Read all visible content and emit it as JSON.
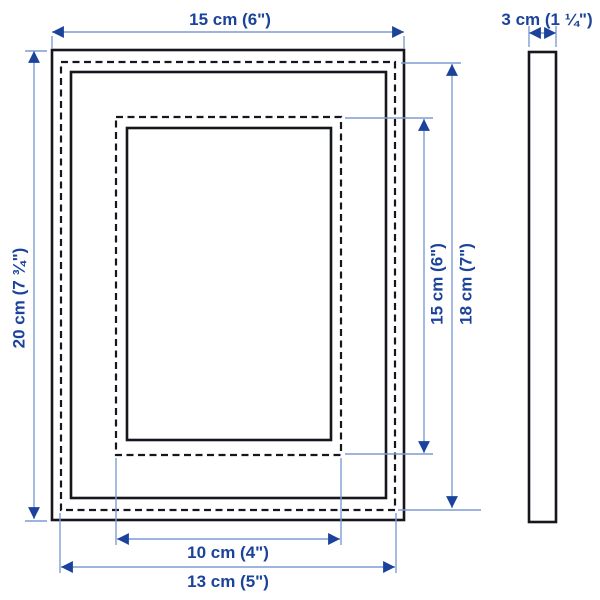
{
  "colors": {
    "background": "#ffffff",
    "frame_line": "#15171c",
    "dimension_line": "#7d9cd4",
    "dimension_accent": "#1c439b"
  },
  "front_view": {
    "outer_width_label": "15 cm (6\")",
    "outer_height_label": "20 cm (7 ¾\")",
    "glass_width_label": "13 cm (5\")",
    "glass_height_label": "18 cm (7\")",
    "opening_width_label": "10 cm (4\")",
    "opening_height_label": "15 cm (6\")"
  },
  "side_view": {
    "depth_label": "3 cm (1 ¼\")"
  }
}
